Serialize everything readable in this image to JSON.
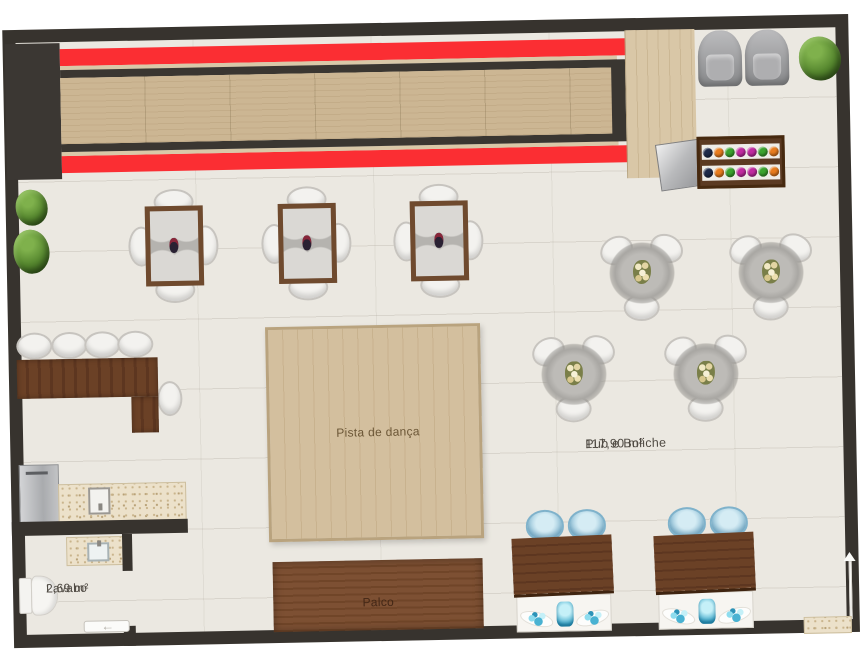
{
  "plan": {
    "type": "floor-plan",
    "labels": {
      "main_room_name": "Pub e Boliche",
      "main_room_area": "117,90 m²",
      "dance_floor": "Pista de dança",
      "stage": "Palco",
      "washroom_name": "Lavabo",
      "washroom_area": "2,69 m²"
    },
    "door_arrows": {
      "washroom": "←",
      "entrance": "↑"
    },
    "colors": {
      "wall": "#37332e",
      "floor": "#ebe8e1",
      "bowling_gutter_red": "#fb2e33",
      "lane_wood": "#ccb693",
      "deck_wood": "#d9c7a7",
      "dark_wood_furniture": "#6b4126",
      "dance_floor_wood": "#d3bf9e",
      "stage_wood": "#7d5033",
      "granite_counter": "#ece1ca",
      "armchair_gray": "#9fa0a2",
      "chair_white": "#f3f2ef",
      "chair_blue": "#9cc8dc",
      "plant_green": "#55862e"
    },
    "bowling": {
      "lanes": 1,
      "ball_rack": {
        "rows": 2,
        "balls_per_row": 7,
        "ball_colors": [
          "#1e2a4a",
          "#e87c1e",
          "#3ba32f",
          "#c02ba0",
          "#c02ba0",
          "#3ba32f",
          "#e87c1e"
        ]
      },
      "armchairs": 2,
      "ball_return_machine": 1
    },
    "furniture": {
      "square_tables": {
        "count": 3,
        "chairs_each": 4,
        "centerpiece": "wine bottle"
      },
      "round_tables": {
        "count": 4,
        "chairs_each": 3,
        "centerpiece": "flowers"
      },
      "bar_counter": "L-shaped",
      "bar_stools": 5,
      "refrigerator": 1,
      "sink_counters": 2,
      "toilet": 1,
      "bar_table_stations": {
        "count": 2,
        "chairs_each": 2
      },
      "plants": 3,
      "sliding_doors": 2
    }
  }
}
